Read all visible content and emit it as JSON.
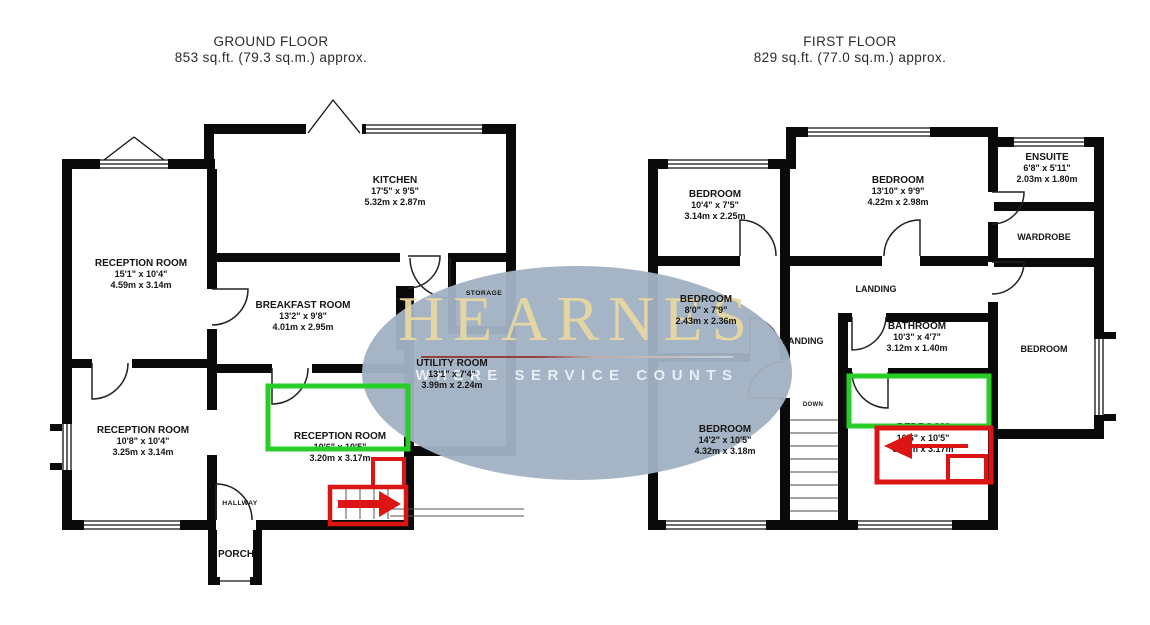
{
  "ground_floor": {
    "title": "GROUND FLOOR",
    "area": "853 sq.ft. (79.3 sq.m.) approx.",
    "rooms": [
      {
        "id": "kitchen",
        "name": "KITCHEN",
        "imperial": "17'5\" x 9'5\"",
        "metric": "5.32m x 2.87m"
      },
      {
        "id": "reception-front",
        "name": "RECEPTION ROOM",
        "imperial": "15'1\" x 10'4\"",
        "metric": "4.59m x 3.14m"
      },
      {
        "id": "breakfast-room",
        "name": "BREAKFAST ROOM",
        "imperial": "13'2\" x 9'8\"",
        "metric": "4.01m x 2.95m"
      },
      {
        "id": "storage",
        "name": "STORAGE"
      },
      {
        "id": "utility-room",
        "name": "UTILITY ROOM",
        "imperial": "13'1\" x 7'4\"",
        "metric": "3.99m x 2.24m"
      },
      {
        "id": "reception-side",
        "name": "RECEPTION ROOM",
        "imperial": "10'8\" x 10'4\"",
        "metric": "3.25m x 3.14m"
      },
      {
        "id": "reception-rear",
        "name": "RECEPTION ROOM",
        "imperial": "10'6\" x 10'5\"",
        "metric": "3.20m x 3.17m"
      },
      {
        "id": "hallway",
        "name": "HALLWAY"
      },
      {
        "id": "porch",
        "name": "PORCH"
      }
    ]
  },
  "first_floor": {
    "title": "FIRST FLOOR",
    "area": "829 sq.ft. (77.0 sq.m.) approx.",
    "rooms": [
      {
        "id": "bedroom-front-left",
        "name": "BEDROOM",
        "imperial": "10'4\" x 7'5\"",
        "metric": "3.14m x 2.25m"
      },
      {
        "id": "bedroom-front",
        "name": "BEDROOM",
        "imperial": "13'10\" x 9'9\"",
        "metric": "4.22m x 2.98m"
      },
      {
        "id": "ensuite",
        "name": "ENSUITE",
        "imperial": "6'8\" x 5'11\"",
        "metric": "2.03m x 1.80m"
      },
      {
        "id": "wardrobe",
        "name": "WARDROBE"
      },
      {
        "id": "landing",
        "name": "LANDING"
      },
      {
        "id": "bedroom-mid",
        "name": "BEDROOM",
        "imperial": "8'0\" x 7'9\"",
        "metric": "2.43m x 2.36m"
      },
      {
        "id": "landing-lower",
        "name": "LANDING"
      },
      {
        "id": "bathroom",
        "name": "BATHROOM",
        "imperial": "10'3\" x 4'7\"",
        "metric": "3.12m x 1.40m"
      },
      {
        "id": "down",
        "name": "DOWN"
      },
      {
        "id": "bedroom-rear-left",
        "name": "BEDROOM",
        "imperial": "14'2\" x 10'5\"",
        "metric": "4.32m x 3.18m"
      },
      {
        "id": "bedroom-rear",
        "name": "BEDROOM",
        "imperial": "10'6\" x 10'5\"",
        "metric": "3.20m x 3.17m"
      },
      {
        "id": "bedroom-right",
        "name": "BEDROOM"
      }
    ]
  },
  "watermark": {
    "brand": "HEARNES",
    "tagline": "WHERE SERVICE COUNTS",
    "ellipse_color": "#a3b2c3",
    "brand_color": "#e7d7a2",
    "tagline_color": "#edf1f5"
  },
  "annotation_colors": {
    "highlight_green": "#27ce27",
    "marker_red": "#dc1414",
    "wall_black": "#0a0a0a"
  }
}
